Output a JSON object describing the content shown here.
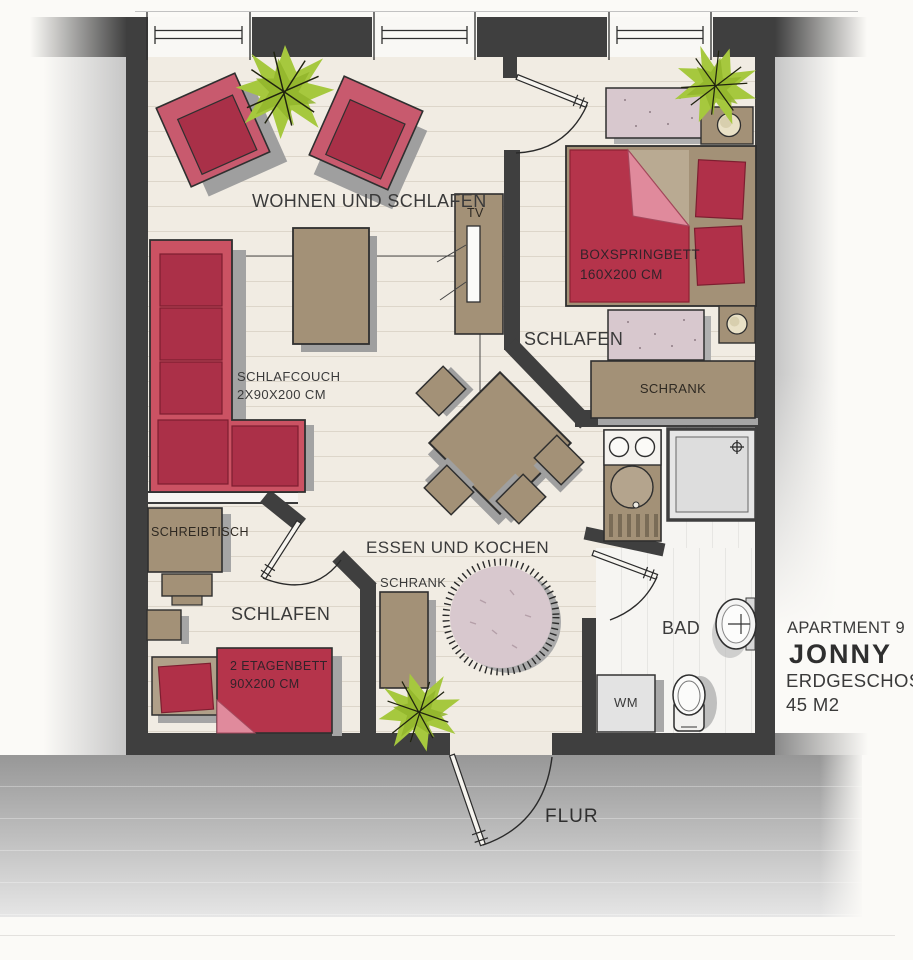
{
  "info_block": {
    "apartment": "APARTMENT 9",
    "name": "JONNY",
    "floor": "ERDGESCHOSS",
    "area": "45 M2"
  },
  "rooms": {
    "living_sleeping": "WOHNEN UND SCHLAFEN",
    "bedroom": "SCHLAFEN",
    "kids_bedroom": "SCHLAFEN",
    "dining_kitchen": "ESSEN UND KOCHEN",
    "bathroom": "BAD",
    "hallway": "FLUR"
  },
  "furniture": {
    "sleep_couch": {
      "label": "SCHLAFCOUCH",
      "size": "2X90X200 CM"
    },
    "boxspring_bed": {
      "label": "BOXSPRINGBETT",
      "size": "160X200 CM"
    },
    "bunk_bed": {
      "label": "2 ETAGENBETT",
      "size": "90X200 CM"
    },
    "wardrobe_bedroom": "SCHRANK",
    "wardrobe_dining": "SCHRANK",
    "desk": "SCHREIBTISCH",
    "tv": "TV",
    "washing_machine": "WM"
  },
  "colors": {
    "wall": "#3f3f3f",
    "floor": "#f1ece3",
    "bath_floor": "#f6f5f2",
    "red_furniture": "#b5344b",
    "red_frame": "#cb5263",
    "taupe_furniture": "#a39177",
    "pink_textile": "#d8c8ce",
    "fold_pink": "#e08a9c",
    "plant_green": "#a6c83e",
    "hall_grey": "#9a9a9a",
    "shadow_grey": "#9f9f9f",
    "paper": "#fbfaf7"
  }
}
